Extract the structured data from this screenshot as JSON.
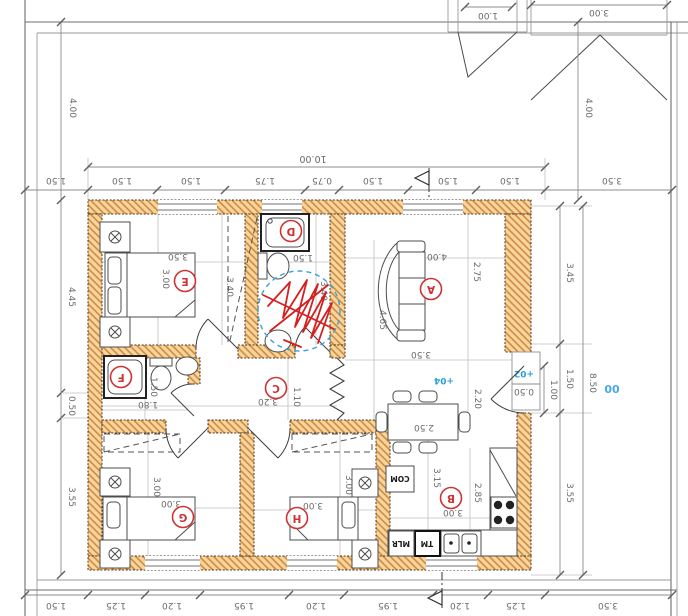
{
  "drawing": {
    "kind": "house floor plan, sheet rotated 180 degrees",
    "overall_width": "10.00",
    "overall_height_right": "8.50"
  },
  "site": {
    "canopy_small": "1.00",
    "canopy_large": "3.00",
    "setback_left": "4.00",
    "setback_right": "4.00"
  },
  "dims": {
    "top_chain": [
      "1.50",
      "1.50",
      "1.50",
      "1.75",
      "0.75",
      "1.50",
      "1.50",
      "1.50",
      "3.50"
    ],
    "bottom_chain": [
      "1.50",
      "1.25",
      "1.20",
      "1.95",
      "1.20",
      "1.95",
      "1.20",
      "1.25",
      "3.50"
    ],
    "left_chain": [
      "4.45",
      "0.50",
      "3.55"
    ],
    "right_chain": [
      "3.45",
      "1.50",
      "3.55"
    ]
  },
  "entrance": {
    "step": "0.50",
    "door": "1.00",
    "outside_level": "+02",
    "inside_level": "+04",
    "ground_level": "00"
  },
  "rooms": {
    "A": {
      "letter": "A",
      "dims": [
        "4.00",
        "2.75",
        "4.65",
        "3.50"
      ]
    },
    "B": {
      "letter": "B",
      "dims": [
        "3.15",
        "2.85",
        "3.00"
      ]
    },
    "C": {
      "letter": "C",
      "dims": [
        "3.20",
        "1.10"
      ]
    },
    "D": {
      "letter": "D",
      "dims": [
        "1.50",
        "3.40"
      ]
    },
    "E": {
      "letter": "E",
      "dims": [
        "3.50",
        "3.00",
        "3.40"
      ]
    },
    "F": {
      "letter": "F",
      "dims": [
        "1.80",
        "1.50"
      ]
    },
    "G": {
      "letter": "G",
      "dims": [
        "3.00",
        "3.00"
      ]
    },
    "H": {
      "letter": "H",
      "dims": [
        "3.00",
        "3.00"
      ]
    }
  },
  "dining": {
    "table_length": "2.50",
    "width": "2.20"
  },
  "kitchen": {
    "appliances": [
      "COM",
      "MLR",
      "TM"
    ]
  },
  "colors": {
    "wall_fill": "#f9d49b",
    "wall_hatch": "#c9873d",
    "dim_text": "#6a6a6a",
    "room_label": "#cc3333",
    "level_blue": "#2b9fd8",
    "annotation_red": "#d42020",
    "annotation_blue": "#3aa0e0"
  }
}
